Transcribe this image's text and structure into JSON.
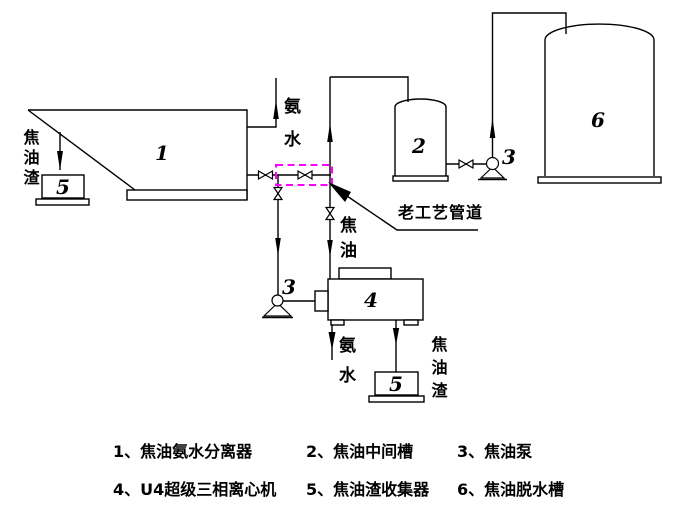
{
  "colors": {
    "ink": "#000000",
    "background": "#ffffff",
    "old_pipeline_box": "#ff00ff"
  },
  "streams": {
    "ammonia_water_top": "氨水",
    "tar_residue_left": "焦油渣",
    "tar": "焦油",
    "ammonia_water_bottom": "氨水",
    "tar_residue_bottom": "焦油渣"
  },
  "annotations": {
    "old_pipeline": "老工艺管道"
  },
  "equipment": {
    "separator": "1",
    "intermediate_tank": "2",
    "tar_pump_right": "3",
    "tar_pump_left": "3",
    "centrifuge": "4",
    "residue_collector_left": "5",
    "residue_collector_bottom": "5",
    "dewatering_tank": "6"
  },
  "legend": {
    "row1": [
      {
        "text": "1、焦油氨水分离器"
      },
      {
        "text": "2、焦油中间槽"
      },
      {
        "text": "3、焦油泵"
      }
    ],
    "row2": [
      {
        "text": "4、U4超级三相离心机"
      },
      {
        "text": "5、焦油渣收集器"
      },
      {
        "text": "6、焦油脱水槽"
      }
    ]
  }
}
